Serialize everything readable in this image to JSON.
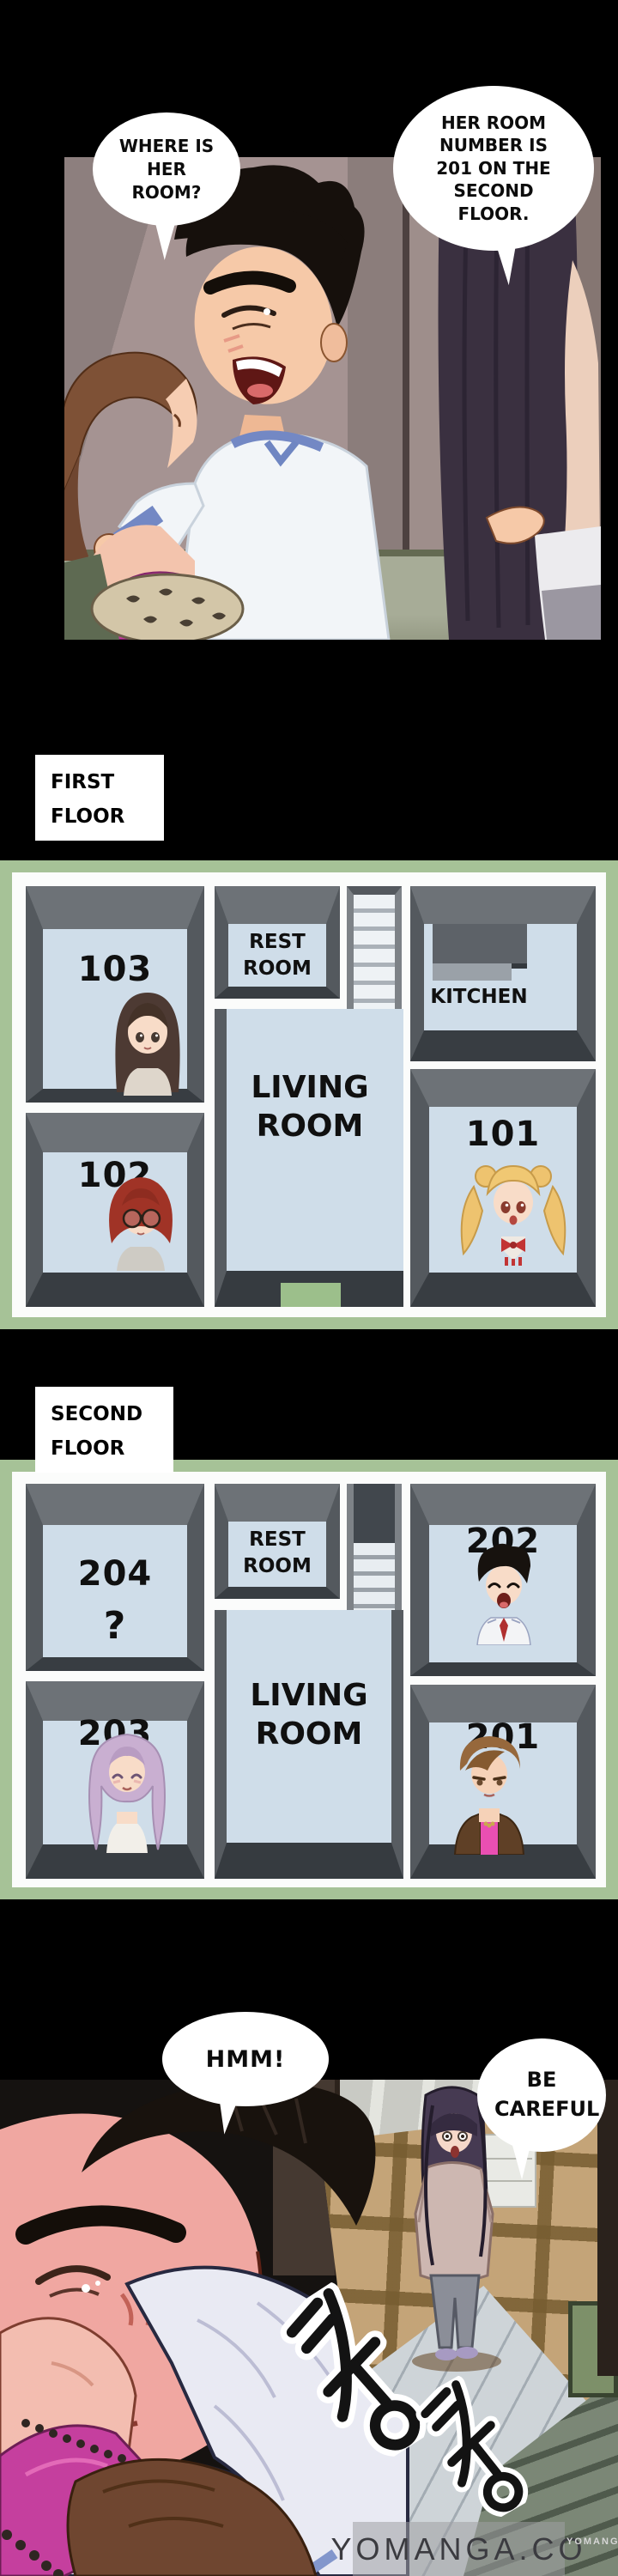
{
  "colors": {
    "page_bg": "#000000",
    "plan_frame_green": "#a6c297",
    "room_floor_blue": "#cfdde9",
    "wall_dark": "#383d42",
    "wall_mid": "#6d7277",
    "door_mat_green": "#9cbf8b",
    "speech_bubble": "#ffffff"
  },
  "panel_top": {
    "bubbles": [
      {
        "text": "WHERE IS HER ROOM?"
      },
      {
        "text": "HER ROOM NUMBER IS 201 ON THE SECOND FLOOR."
      }
    ]
  },
  "first_floor": {
    "label": "FIRST FLOOR",
    "rooms": {
      "r103": "103",
      "r102": "102",
      "r101": "101",
      "restroom": "REST ROOM",
      "kitchen": "KITCHEN",
      "living": "LIVING ROOM"
    },
    "occupants": {
      "r103": "girl-long-dark-hair",
      "r102": "girl-red-hair-glasses",
      "r101": "girl-blonde-twintails"
    }
  },
  "second_floor": {
    "label": "SECOND FLOOR",
    "rooms": {
      "r204": "204",
      "r204_unknown": "?",
      "r203": "203",
      "r202": "202",
      "r201": "201",
      "restroom": "REST ROOM",
      "living": "LIVING ROOM"
    },
    "occupants": {
      "r202": "boy-black-hair",
      "r203": "girl-lavender-hair",
      "r201": "girl-brown-hair-pink-top"
    }
  },
  "panel_bottom": {
    "bubbles": [
      {
        "text": "HMM!"
      },
      {
        "text": "BE CAREFUL"
      }
    ],
    "sfx": [
      {
        "text": "쿵"
      },
      {
        "text": "쿵"
      }
    ]
  },
  "watermark": {
    "main": "YOMANGA.CO",
    "small": "YOMANGA"
  }
}
